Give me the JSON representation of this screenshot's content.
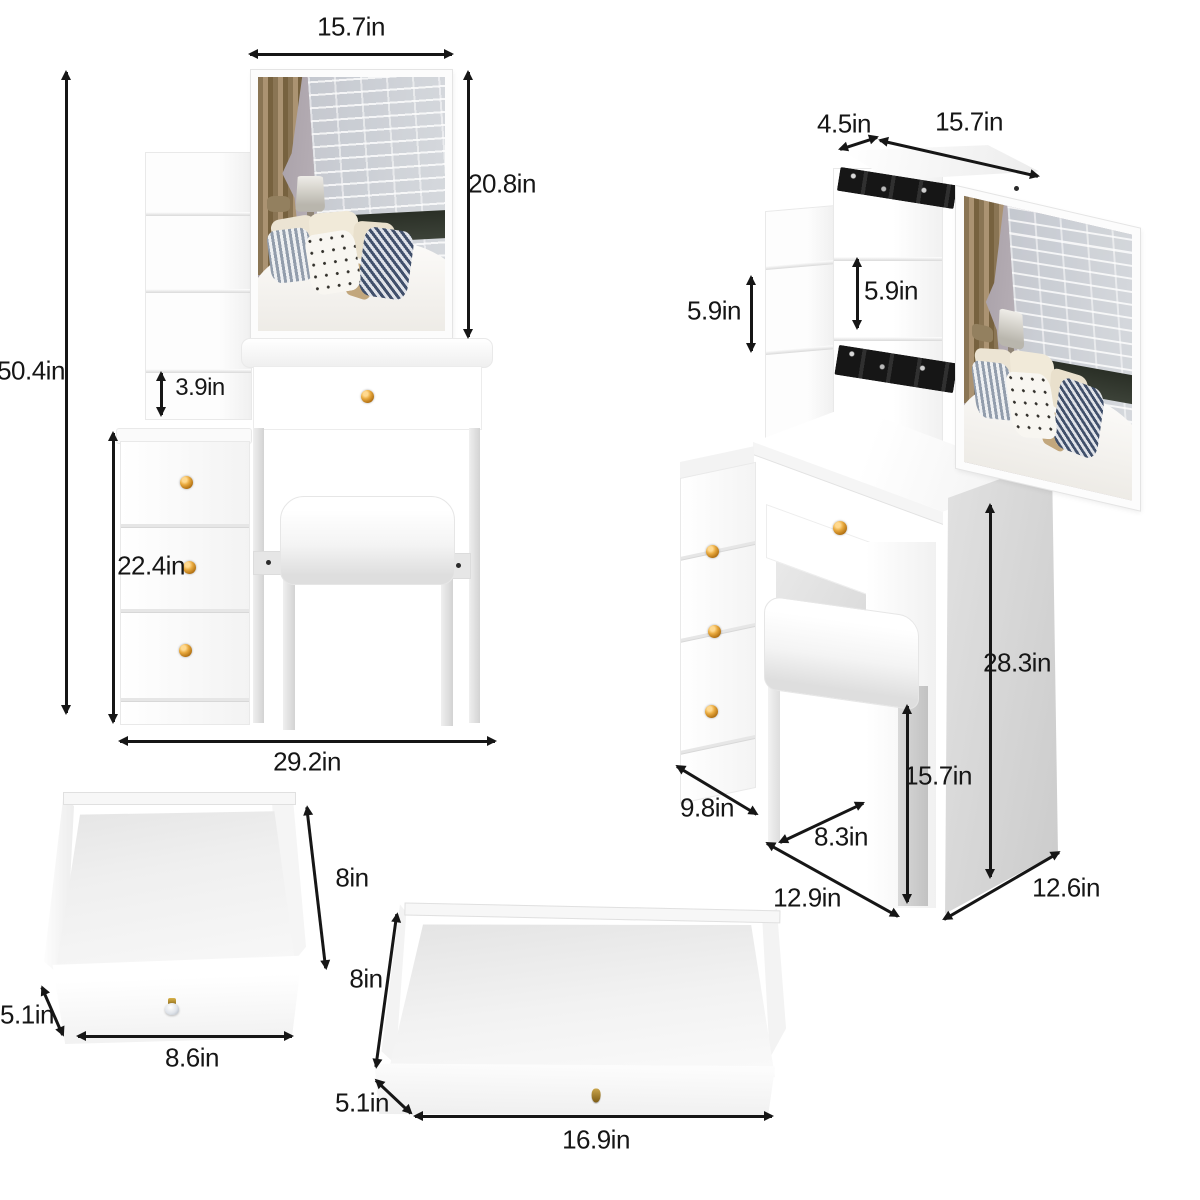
{
  "colors": {
    "label": "#161616",
    "arrow": "#161616",
    "knob_gold": "#c9841c",
    "rail_black": "#1b1b1b",
    "panel_gray": "#d3d3d3",
    "furniture_white": "#ffffff"
  },
  "views": {
    "front": {
      "labels": {
        "mirror_width": "15.7in",
        "mirror_height": "20.8in",
        "total_height": "50.4in",
        "shelf_gap": "3.9in",
        "cabinet_height": "22.4in",
        "total_width": "29.2in"
      }
    },
    "side": {
      "labels": {
        "hutch_depth": "4.5in",
        "mirror_width": "15.7in",
        "left_shelf_height": "5.9in",
        "middle_shelf_height": "5.9in",
        "desk_height": "28.3in",
        "stool_height": "15.7in",
        "cabinet_depth": "9.8in",
        "stool_depth": "8.3in",
        "desk_depth": "12.9in",
        "side_panel_depth": "12.6in"
      }
    },
    "small_drawer": {
      "labels": {
        "depth": "8in",
        "height": "5.1in",
        "width": "8.6in"
      }
    },
    "large_drawer": {
      "labels": {
        "depth": "8in",
        "height": "5.1in",
        "width": "16.9in"
      }
    }
  }
}
